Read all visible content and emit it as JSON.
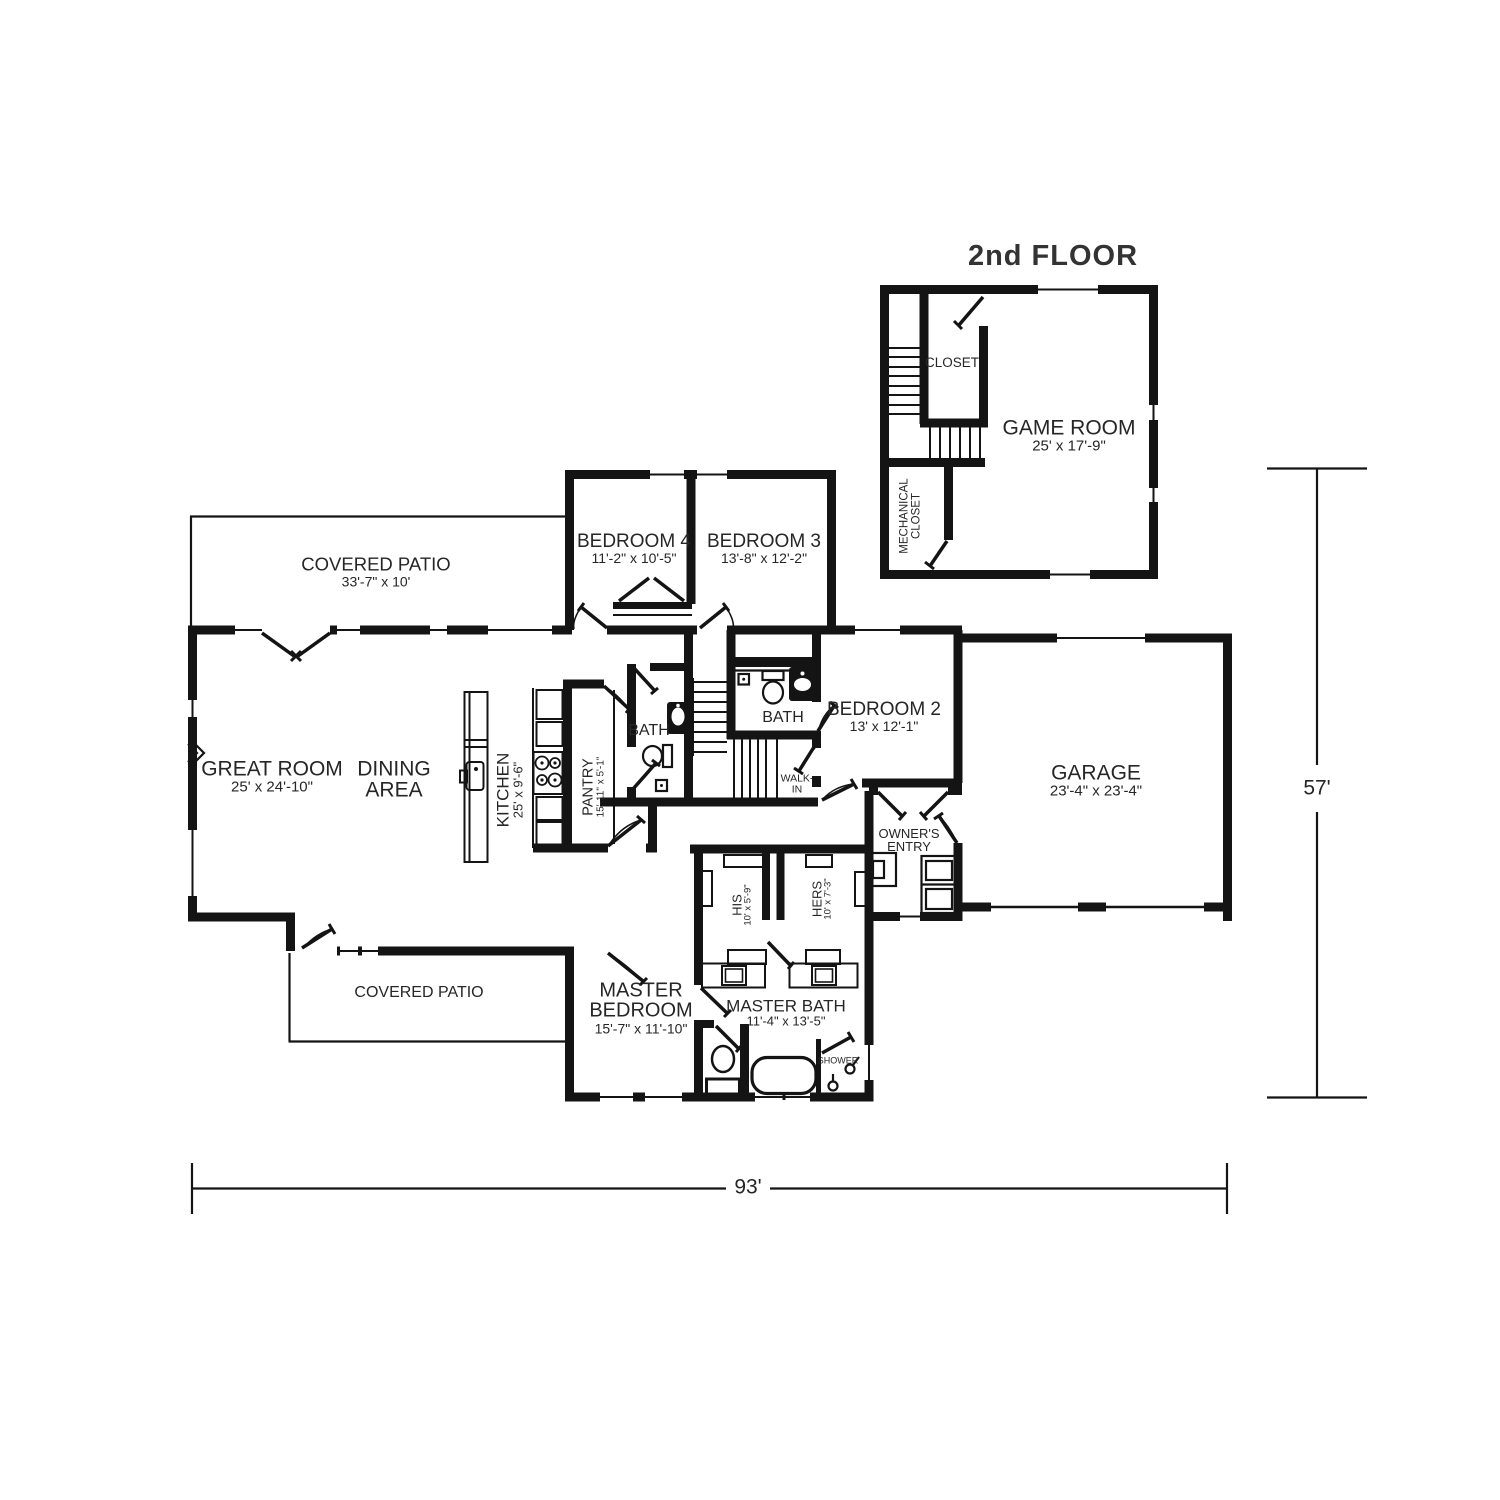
{
  "title": "2nd FLOOR",
  "dimension_labels": {
    "width": "93'",
    "height": "57'"
  },
  "second_floor": {
    "closet": {
      "label": "CLOSET"
    },
    "game_room": {
      "label": "GAME ROOM",
      "size": "25' x 17'-9\""
    },
    "mechanical_closet": {
      "line1": "MECHANICAL",
      "line2": "CLOSET"
    }
  },
  "first_floor": {
    "covered_patio_top": {
      "label": "COVERED PATIO",
      "size": "33'-7\" x 10'"
    },
    "great_room": {
      "label": "GREAT ROOM",
      "size": "25' x 24'-10\""
    },
    "dining_area": {
      "line1": "DINING",
      "line2": "AREA"
    },
    "kitchen": {
      "label": "KITCHEN",
      "size": "25' x 9'-6\""
    },
    "pantry": {
      "label": "PANTRY",
      "size": "15'-11\" x 5'-1\""
    },
    "bath": {
      "label": "BATH"
    },
    "bath2": {
      "label": "BATH"
    },
    "bedroom4": {
      "label": "BEDROOM 4",
      "size": "11'-2\" x 10'-5\""
    },
    "bedroom3": {
      "label": "BEDROOM 3",
      "size": "13'-8\" x 12'-2\""
    },
    "bedroom2": {
      "label": "BEDROOM 2",
      "size": "13' x 12'-1\""
    },
    "walk_in": {
      "line1": "WALK-",
      "line2": "IN"
    },
    "garage": {
      "label": "GARAGE",
      "size": "23'-4\" x 23'-4\""
    },
    "owners_entry": {
      "line1": "OWNER'S",
      "line2": "ENTRY"
    },
    "his_closet": {
      "label": "HIS",
      "size": "10' x 5'-9\""
    },
    "hers_closet": {
      "label": "HERS",
      "size": "10' x 7'-3\""
    },
    "covered_patio_bottom": {
      "label": "COVERED PATIO"
    },
    "master_bedroom": {
      "line1": "MASTER",
      "line2": "BEDROOM",
      "size": "15'-7\" x 11'-10\""
    },
    "master_bath": {
      "label": "MASTER BATH",
      "size": "11'-4\" x 13'-5\""
    },
    "shower": {
      "label": "SHOWER"
    }
  },
  "colors": {
    "wall": "#141414",
    "text": "#262626"
  }
}
